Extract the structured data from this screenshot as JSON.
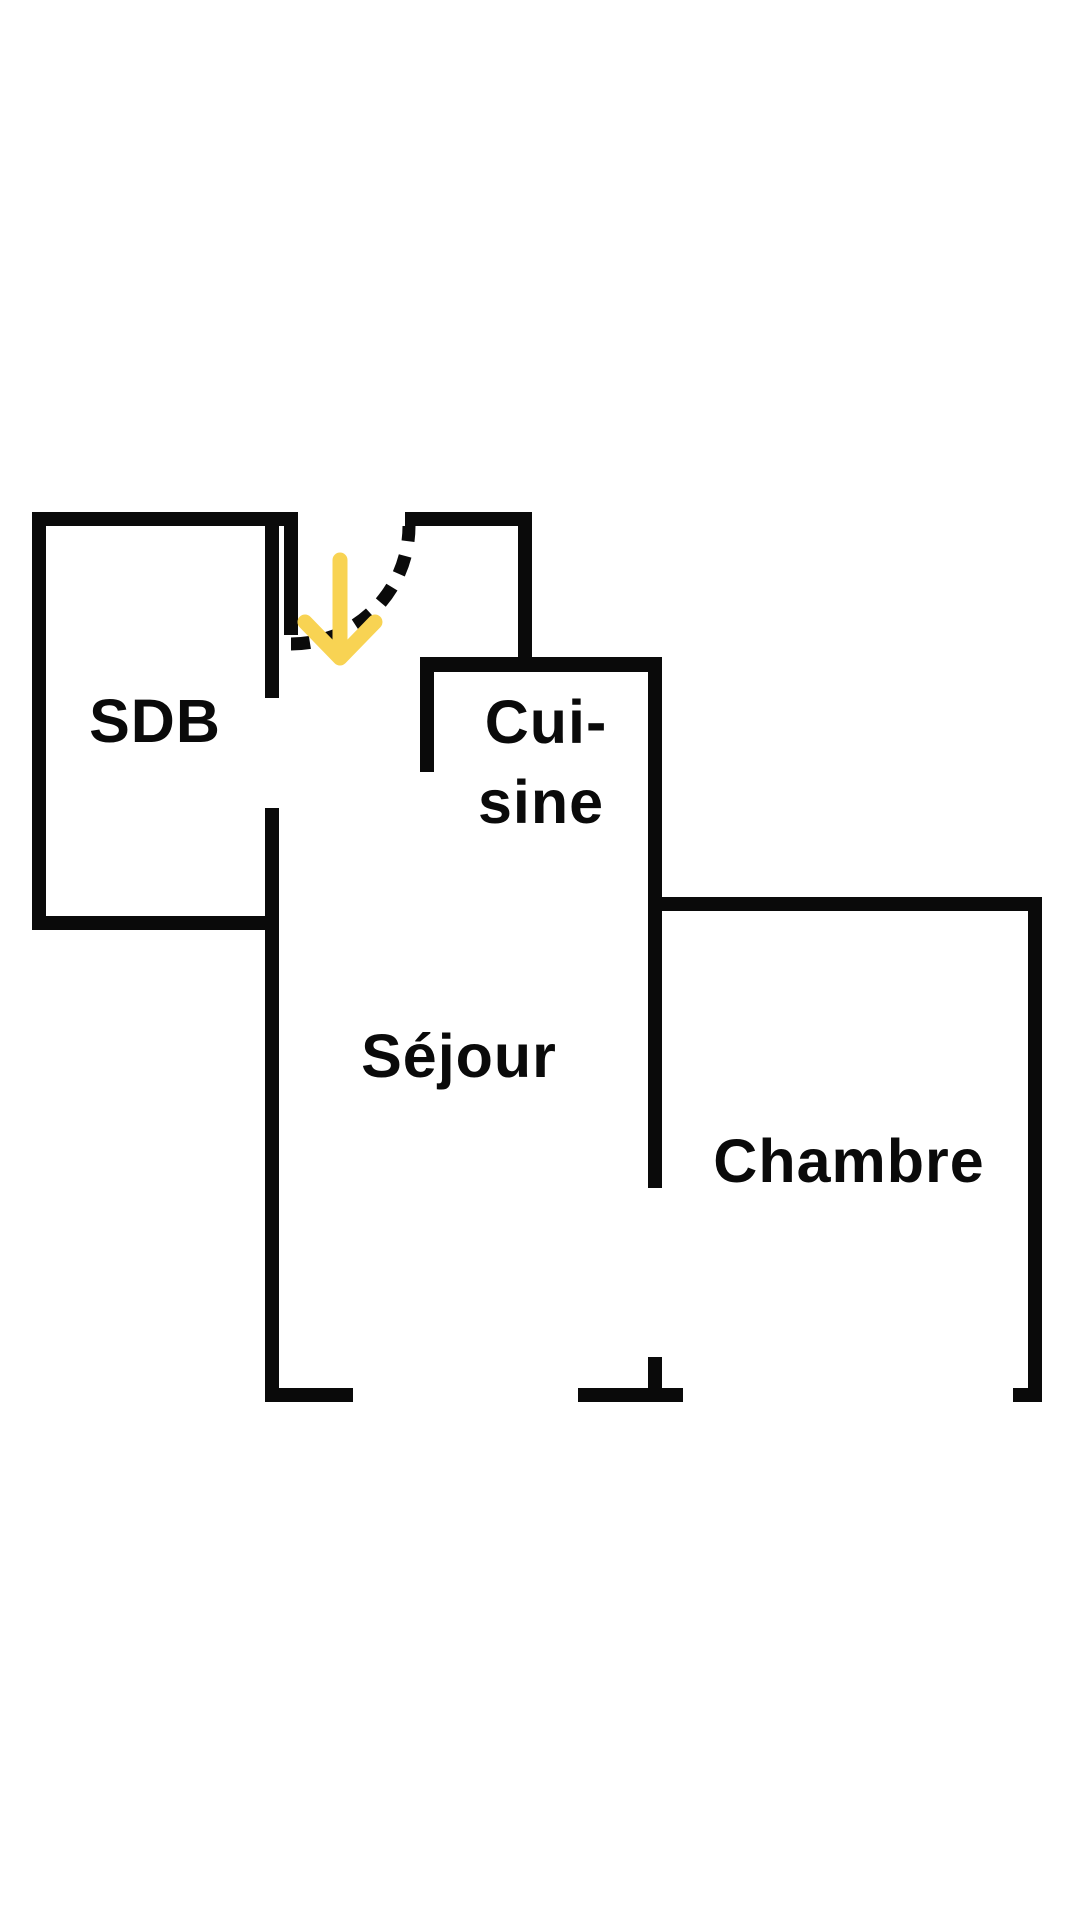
{
  "canvas": {
    "background": "#ffffff"
  },
  "colors": {
    "wall": "#0a0a0a",
    "label": "#0a0a0a",
    "arrow": "#F8D353"
  },
  "floor_plan": {
    "rooms": {
      "sdb": {
        "label": "SDB"
      },
      "cuisine": {
        "label_line1": "Cui-",
        "label_line2": "sine"
      },
      "sejour": {
        "label": "Séjour"
      },
      "chambre": {
        "label": "Chambre"
      }
    },
    "entrance": {
      "arrow_icon": "down-arrow",
      "arrow_glyph": "↓",
      "door_swing": "dashed-quarter-arc"
    }
  }
}
